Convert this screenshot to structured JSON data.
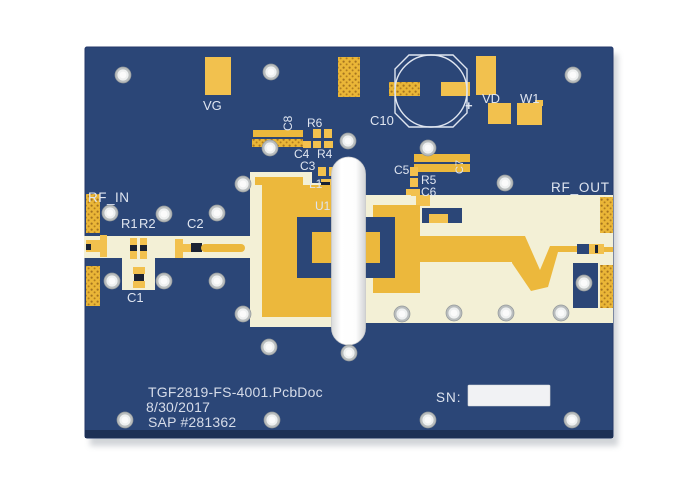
{
  "image": {
    "type": "pcb-evaluation-board-photo",
    "background": "#ffffff"
  },
  "board": {
    "part_labels": {
      "vg": "VG",
      "c8": "C8",
      "r6": "R6",
      "c10": "C10",
      "c10_plus": "+",
      "vd": "VD",
      "w1": "W1",
      "c4": "C4",
      "r4": "R4",
      "c3": "C3",
      "l1": "L1",
      "u1": "U1",
      "c5": "C5",
      "r5": "R5",
      "c6": "C6",
      "c7": "C7",
      "rf_in": "RF_IN",
      "rf_out": "RF_OUT",
      "r1": "R1",
      "r2": "R2",
      "c2": "C2",
      "c1": "C1"
    },
    "bottom_text": {
      "doc_name": "TGF2819-FS-4001.PcbDoc",
      "date": "8/30/2017",
      "sap": "SAP #281362"
    },
    "serial": {
      "label": "SN:"
    },
    "colors": {
      "substrate": "#2b4677",
      "substrate_edge": "#1d3055",
      "gold": "#ecb83c",
      "pad_gold": "#f2c14e",
      "via_dot": "#a5741f",
      "cream": "#f3f0d6",
      "silkscreen": "#dfe5f0",
      "component_gap": "#1a2233",
      "hole_ring": "#b9bdbe",
      "sn_box": "#f1f2f4"
    },
    "holes": [
      [
        123,
        75
      ],
      [
        271,
        72
      ],
      [
        573,
        75
      ],
      [
        270,
        148
      ],
      [
        348,
        141
      ],
      [
        428,
        148
      ],
      [
        505,
        183
      ],
      [
        243,
        184
      ],
      [
        110,
        213
      ],
      [
        164,
        214
      ],
      [
        217,
        213
      ],
      [
        112,
        281
      ],
      [
        164,
        281
      ],
      [
        217,
        281
      ],
      [
        243,
        314
      ],
      [
        269,
        347
      ],
      [
        349,
        353
      ],
      [
        402,
        314
      ],
      [
        454,
        313
      ],
      [
        506,
        313
      ],
      [
        561,
        313
      ],
      [
        584,
        283
      ],
      [
        125,
        420
      ],
      [
        272,
        420
      ],
      [
        428,
        420
      ],
      [
        572,
        420
      ]
    ]
  }
}
